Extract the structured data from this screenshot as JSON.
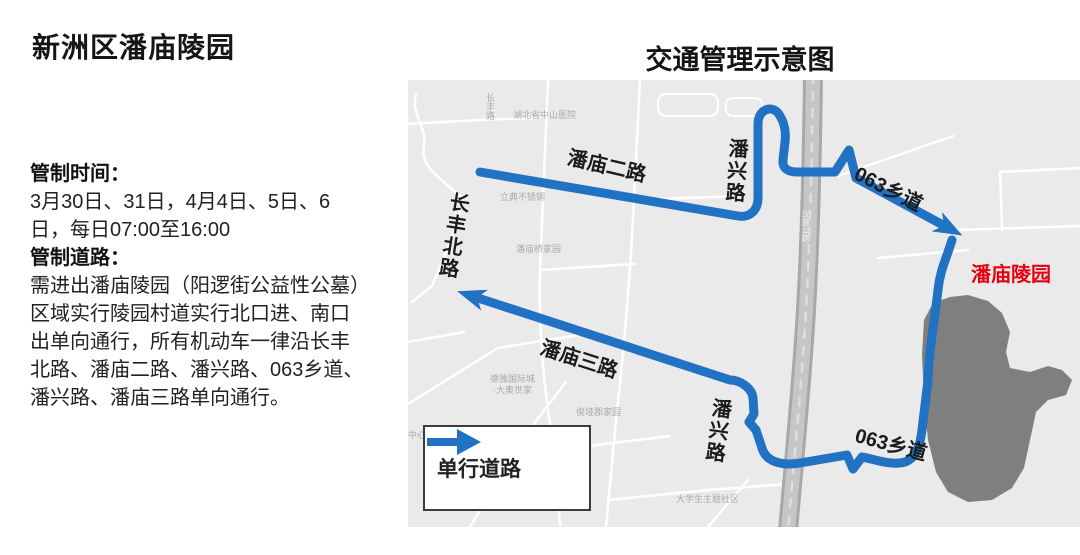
{
  "left_panel": {
    "title": "新洲区潘庙陵园",
    "lines": [
      {
        "text": "管制时间：",
        "bold": true
      },
      {
        "text": "3月30日、31日，4月4日、5日、6",
        "bold": false
      },
      {
        "text": "日，每日07:00至16:00",
        "bold": false
      },
      {
        "text": "管制道路：",
        "bold": true
      },
      {
        "text": "需进出潘庙陵园（阳逻街公益性公墓）",
        "bold": false
      },
      {
        "text": "区域实行陵园村道实行北口进、南口",
        "bold": false
      },
      {
        "text": "出单向通行，所有机动车一律沿长丰",
        "bold": false
      },
      {
        "text": "北路、潘庙二路、潘兴路、063乡道、",
        "bold": false
      },
      {
        "text": "潘兴路、潘庙三路单向通行。",
        "bold": false
      }
    ]
  },
  "map": {
    "title": "交通管理示意图",
    "labels": {
      "road_panmiao2": "潘庙二路",
      "road_changfeng_north": "长丰北路",
      "road_panxing_top": "潘兴路",
      "road_063_top": "063乡道",
      "road_panmiao3": "潘庙三路",
      "road_panxing_bottom": "潘兴路",
      "road_063_bottom": "063乡道",
      "destination": "潘庙陵园"
    },
    "background_labels": {
      "hospital": "湖北省中山医院",
      "steel_plant": "立典不锈钢",
      "panmiao_bridge": "潘庙桥家园",
      "deya_line1": "德雅国际城",
      "deya_line2": "·大奥世家",
      "junya": "俊垭郡家园",
      "student_community": "大学生主题社区",
      "center": "中心",
      "small_road": "长丰路",
      "highway": "汉施公路"
    },
    "legend": {
      "label": "单行道路"
    },
    "colors": {
      "route": "#2272c4",
      "destination_text": "#e60012",
      "map_bg": "#ebeaea",
      "hill": "#7f7f7f",
      "highway": "#a8a8a8"
    }
  }
}
